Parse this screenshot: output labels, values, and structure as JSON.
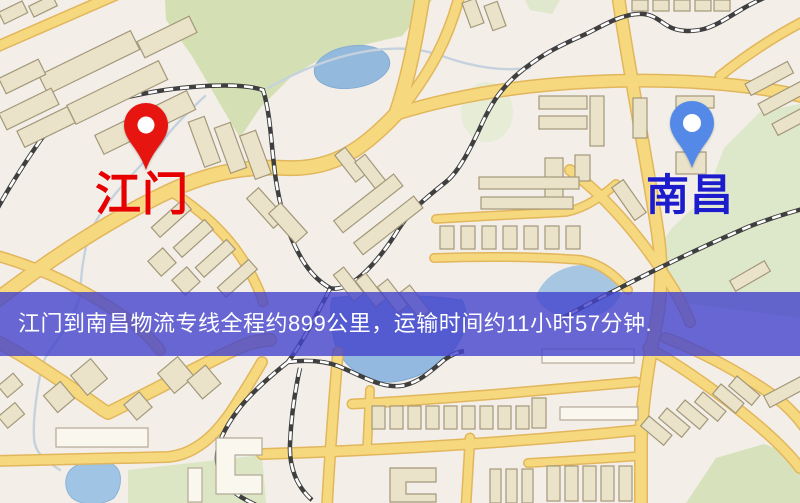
{
  "banner": {
    "text": "江门到南昌物流专线全程约899公里，运输时间约11小时57分钟.",
    "background_color": "#4444cd",
    "text_color": "#ffffff"
  },
  "markers": {
    "origin": {
      "label": "江门",
      "pin_color": "#e6150f",
      "label_color": "#e60000"
    },
    "destination": {
      "label": "南昌",
      "pin_color": "#5589e8",
      "label_color": "#1c1ccd"
    }
  },
  "route": {
    "origin_city": "江门",
    "destination_city": "南昌",
    "distance_text": "约899公里",
    "duration_text": "约11小时57分钟"
  },
  "map_colors": {
    "background": "#f3efe8",
    "road_fill": "#f6d87e",
    "road_casing": "#e2b65c",
    "park_green": "#d4e0b4",
    "water_blue": "#93b9dc",
    "building_beige": "#ebe3c9",
    "railway_dark": "#3f3f3f"
  }
}
